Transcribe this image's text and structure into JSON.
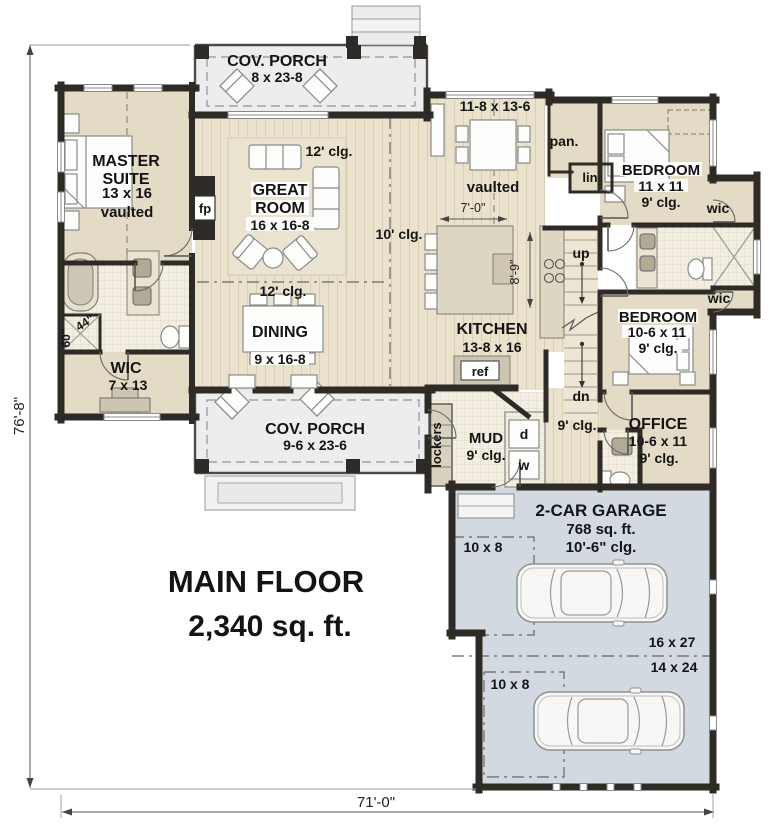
{
  "plan": {
    "title": "MAIN FLOOR",
    "area": "2,340 sq. ft.",
    "overall_depth": "76'-8\"",
    "overall_width": "71'-0\""
  },
  "rooms": {
    "porch_top": {
      "name": "COV. PORCH",
      "size": "8 x 23-8"
    },
    "master": {
      "name1": "MASTER",
      "name2": "SUITE",
      "size": "13 x 16",
      "note": "vaulted"
    },
    "great": {
      "name1": "GREAT",
      "name2": "ROOM",
      "size": "16 x 16-8",
      "clg": "12' clg."
    },
    "nook": {
      "size": "11-8 x 13-6",
      "note": "vaulted"
    },
    "hall_top": {
      "clg": "10' clg."
    },
    "pantry": {
      "name": "pan."
    },
    "linen": {
      "name": "lin"
    },
    "bed1": {
      "name": "BEDROOM",
      "size": "11 x 11",
      "clg": "9' clg."
    },
    "wic1": {
      "name": "wic"
    },
    "wic2": {
      "name": "wic"
    },
    "bed2": {
      "name": "BEDROOM",
      "size": "10-6 x 11",
      "clg": "9' clg."
    },
    "office": {
      "name": "OFFICE",
      "size": "10-6 x 11",
      "clg": "9' clg."
    },
    "kitchen": {
      "name": "KITCHEN",
      "size": "13-8 x 16"
    },
    "dining": {
      "name": "DINING",
      "size": "9 x 16-8",
      "clg": "12' clg."
    },
    "wic_master": {
      "name": "WIC",
      "size": "7 x 13"
    },
    "porch_bottom": {
      "name": "COV. PORCH",
      "size": "9-6 x 23-6"
    },
    "mud": {
      "name": "MUD",
      "clg": "9' clg."
    },
    "hall_bottom": {
      "clg": "9' clg."
    },
    "garage": {
      "name": "2-CAR GARAGE",
      "area": "768 sq. ft.",
      "clg": "10'-6\" clg.",
      "bay1": "16 x 27",
      "bay2": "14 x 24",
      "stor1": "10 x 8",
      "stor2": "10 x 8"
    }
  },
  "fixtures": {
    "fireplace": "fp",
    "refrigerator": "ref",
    "dryer": "d",
    "washer": "w",
    "lockers": "lockers",
    "stairs_up": "up",
    "stairs_down": "dn"
  },
  "dims": {
    "island_width": "7'-0\"",
    "island_depth": "8'-9\"",
    "shower_width": "44\"",
    "shower_depth": "60\""
  },
  "colors": {
    "wall": "#2e2b27",
    "floor_beige": "#e3dbc6",
    "wood": "#eae2cd",
    "tile": "#f2eee2",
    "porch": "#ededee",
    "garage": "#d3d9e1",
    "text": "#141414"
  }
}
